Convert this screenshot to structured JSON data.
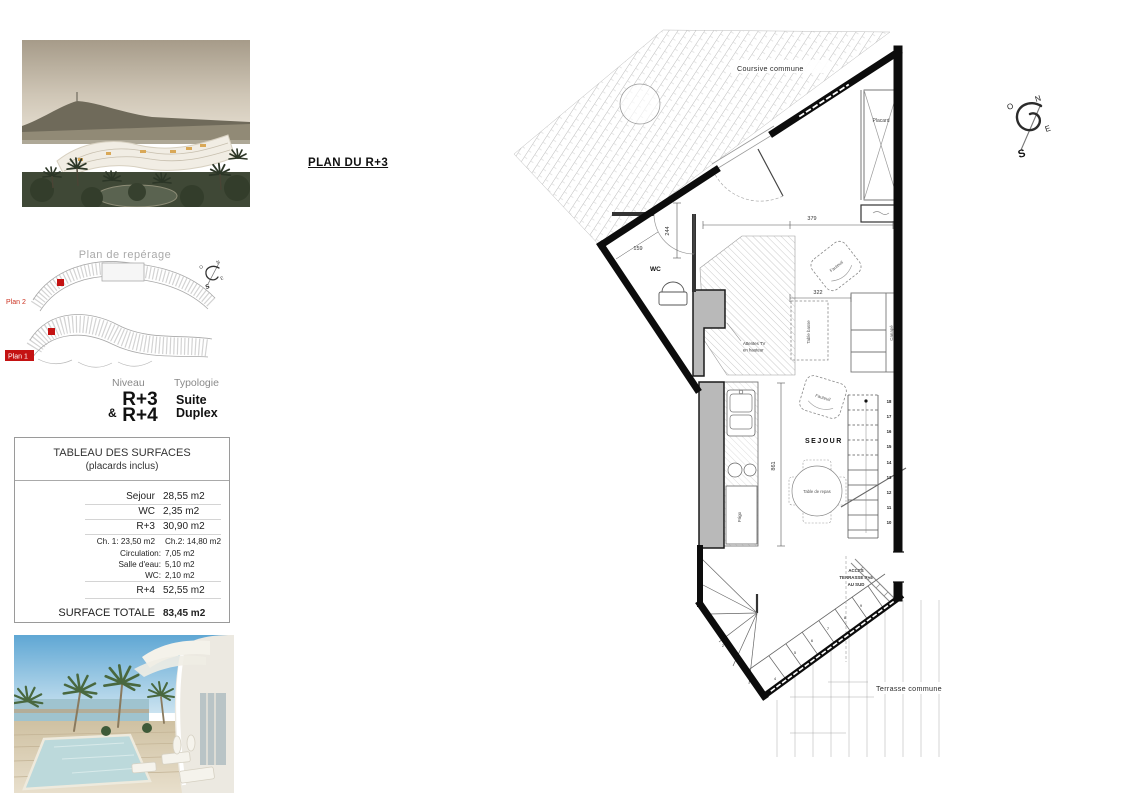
{
  "page": {
    "title_plan": "PLAN DU R+3"
  },
  "reperage": {
    "title": "Plan de repérage",
    "plan1_label": "Plan 1",
    "plan2_label": "Plan 2"
  },
  "niveau": {
    "niveau_label": "Niveau",
    "typologie_label": "Typologie",
    "amp": "&",
    "level1": "R+3",
    "level2": "R+4",
    "typo1": "Suite",
    "typo2": "Duplex"
  },
  "surfaces": {
    "title": "TABLEAU DES SURFACES",
    "subtitle": "(placards inclus)",
    "rows": [
      {
        "label": "Sejour",
        "value": "28,55 m2"
      },
      {
        "label": "WC",
        "value": "2,35 m2"
      },
      {
        "label": "R+3",
        "value": "30,90 m2"
      }
    ],
    "ch_row": {
      "ch1": "Ch. 1:  23,50 m2",
      "ch2": "Ch.2: 14,80 m2"
    },
    "detail_rows": [
      {
        "label": "Circulation:",
        "value": "7,05 m2"
      },
      {
        "label": "Salle d'eau:",
        "value": "5,10 m2"
      },
      {
        "label": "WC:",
        "value": "2,10 m2"
      }
    ],
    "r4_row": {
      "label": "R+4",
      "value": "52,55 m2"
    },
    "total_label": "SURFACE TOTALE",
    "total_value": "83,45 m2"
  },
  "plan": {
    "coursive": "Coursive commune",
    "terrasse": "Terrasse commune",
    "placard": "Placard",
    "wc": "WC",
    "sejour": "SEJOUR",
    "fauteuil1": "Fauteuil",
    "fauteuil2": "Fauteuil",
    "canape": "Canapé",
    "table_basse": "Table basse",
    "table_repas": "Table de repas",
    "frigo": "Frigo",
    "tv_note_line1": "Attentes TV",
    "tv_note_line2": "en hauteur",
    "acces_line1": "ACCES",
    "acces_line2": "TERRASSE R+3",
    "acces_line3": "AU SUD",
    "dims": {
      "d379": "379",
      "d244": "244",
      "d159": "159",
      "d322": "322",
      "d861": "861"
    },
    "stairs_upper": [
      "18",
      "17",
      "16",
      "15",
      "14",
      "13",
      "12",
      "11",
      "10"
    ],
    "stairs_lower": [
      "1",
      "2",
      "3",
      "4",
      "5",
      "6",
      "7",
      "8",
      "9"
    ],
    "compass": {
      "n": "N",
      "e": "E",
      "s": "S",
      "o": "O"
    }
  }
}
